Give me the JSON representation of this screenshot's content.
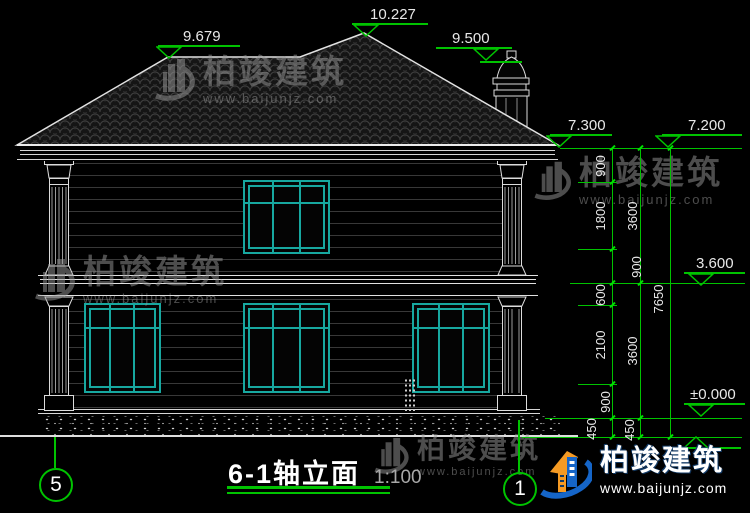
{
  "title": {
    "name": "6-1轴立面",
    "scale": "1:100"
  },
  "axes": {
    "left": "5",
    "right": "1"
  },
  "levels": {
    "ridge": "10.227",
    "left_hip": "9.679",
    "chimney": "9.500",
    "eave_left": "7.300",
    "eave_right": "7.200",
    "floor2": "3.600",
    "ground": "±0.000"
  },
  "dims": {
    "c1": [
      "900",
      "1800",
      "900",
      "600",
      "2100",
      "900",
      "450"
    ],
    "c2": [
      "3600",
      "3600",
      "450"
    ],
    "c3": [
      "7650"
    ]
  },
  "watermark": {
    "brand": "柏竣建筑",
    "url": "www.baijunjz.com"
  },
  "colors": {
    "dim_green": "#00c300",
    "window_teal": "#17a8a0",
    "line_white": "#e6e6e6"
  }
}
